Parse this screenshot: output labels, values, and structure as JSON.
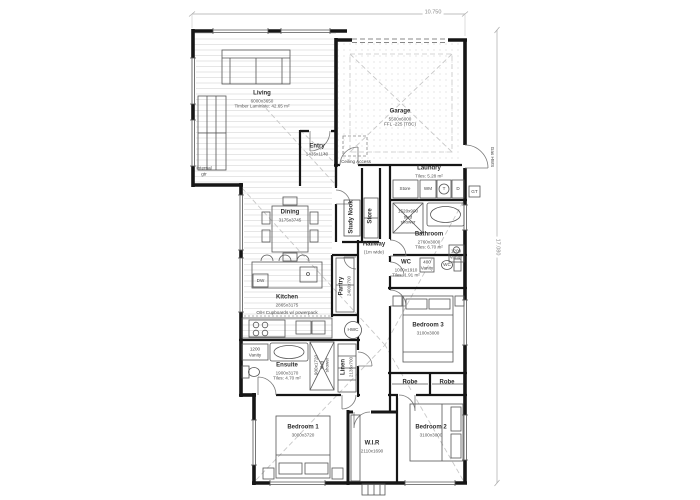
{
  "dimensions": {
    "top": "10.750",
    "right": "17.080"
  },
  "rooms": {
    "living": {
      "name": "Living",
      "size": "6000x3650",
      "note": "Timber Laminate: 42.65 m²"
    },
    "garage": {
      "name": "Garage",
      "size": "5500x6000",
      "note": "FFL -225 (TBC)"
    },
    "entry": {
      "name": "Entry",
      "size": "1435x1140"
    },
    "dining": {
      "name": "Dining",
      "size": "3175x3745"
    },
    "study_nook": {
      "name": "Study Nook"
    },
    "store_nook": {
      "name": "Store"
    },
    "hallway": {
      "name": "Hallway",
      "note": "(1m wide)"
    },
    "laundry": {
      "name": "Laundry",
      "note": "Tiles: 5.28 m²"
    },
    "bathroom": {
      "name": "Bathroom",
      "size": "2760x3000",
      "note": "Tiles: 6.70 m²"
    },
    "wc": {
      "name": "WC",
      "size": "1000x1910",
      "note": "Tiles: 1.91 m²"
    },
    "kitchen": {
      "name": "Kitchen",
      "size": "2865x3175"
    },
    "pantry": {
      "name": "Pantry",
      "size": "2400x700"
    },
    "bedroom3": {
      "name": "Bedroom 3",
      "size": "3100x3000"
    },
    "ensuite": {
      "name": "Ensuite",
      "size": "1900x3170",
      "note": "Tiles: 4.70 m²"
    },
    "linen": {
      "name": "Linen",
      "size": "2135x700"
    },
    "robe": {
      "name": "Robe"
    },
    "bedroom1": {
      "name": "Bedroom 1",
      "size": "3000x3720"
    },
    "wir": {
      "name": "W.I.R",
      "size": "2110x1690"
    },
    "bedroom2": {
      "name": "Bedroom 2",
      "size": "3100x3000"
    }
  },
  "fixtures": {
    "ceiling_access": "Ceiling Access",
    "store_cupboard": "Store",
    "wm": "WM",
    "tub": "T",
    "dryer": "D",
    "gt": "GT",
    "hwc": "HWC",
    "dw": "DW",
    "wc_pan": "WC",
    "vanity1200_l1": "1200",
    "vanity1200_l2": "Vanity",
    "vanity400_l1": "400",
    "vanity400_l2": "Vanity",
    "shower_bath_l1": "1520x900",
    "shower_bath_l2": "tiled",
    "shower_bath_l3": "shower",
    "shower_ens_l1": "900x1720",
    "shower_ens_l2": "tiled",
    "shower_ens_l3": "shower",
    "ohc_note": "O/H Cupboards w/ powerpack",
    "gas_hws": "Gas HWS",
    "gutter_l1": "Internal",
    "gutter_l2": "gtr"
  },
  "colors": {
    "wall": "#161616",
    "line": "#555555",
    "roof_dash": "#c8c8c8",
    "hatch": "#dcdcdc"
  }
}
